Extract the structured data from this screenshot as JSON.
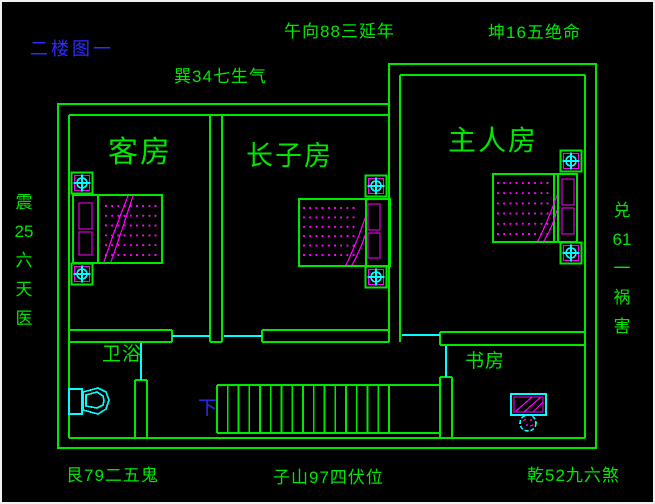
{
  "floor_title": "二楼图一",
  "annotations": {
    "top_center": "午向88三延年",
    "top_right": "坤16五绝命",
    "top_inner": "巽34七生气",
    "left_lines": [
      "震",
      "25",
      "六",
      "天",
      "医"
    ],
    "right_lines": [
      "兑",
      "61",
      "一",
      "祸",
      "害"
    ],
    "bottom_left": "艮79二五鬼",
    "bottom_center": "子山97四伏位",
    "bottom_right": "乾52九六煞"
  },
  "rooms": {
    "guest": "客房",
    "eldest_son": "长子房",
    "master": "主人房",
    "bathroom": "卫浴",
    "study": "书房"
  },
  "stairs": {
    "down_label": "下"
  },
  "colors": {
    "line_green": "#00e800",
    "cyan": "#00ffff",
    "magenta": "#ff00ff",
    "blue": "#2d2dff",
    "background": "#000000",
    "frame": "#f0f0f0"
  }
}
